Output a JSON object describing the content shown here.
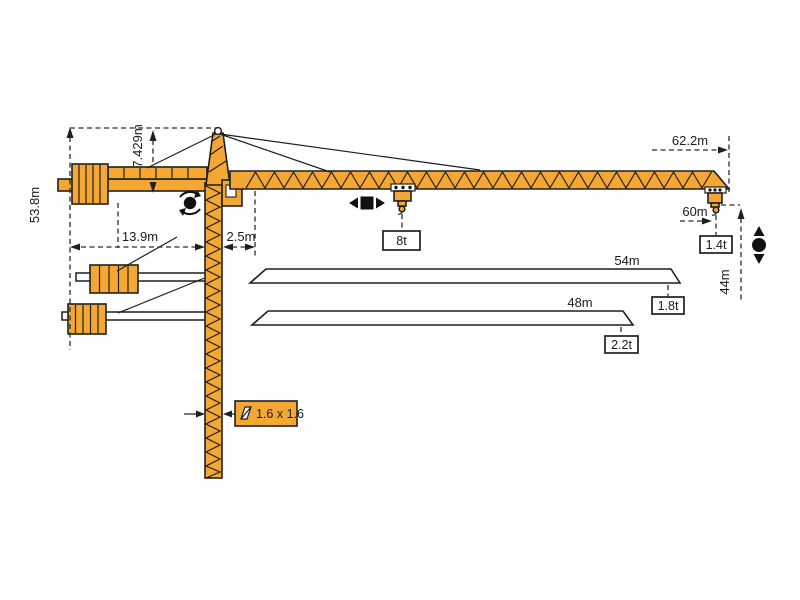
{
  "title": "Tower crane working range and dimension diagram",
  "colors": {
    "crane_orange": "#F5A733",
    "line_black": "#1f1f1f",
    "box_white": "#ffffff"
  },
  "dimensions": {
    "overall_height": "53.8m",
    "tower_head_height": "7.429m",
    "counterjib_radius": "13.9m",
    "jib_foot_offset": "2.5m",
    "max_jib_length": "62.2m",
    "max_hook_radius": "60m",
    "hook_height_at_tip": "44m"
  },
  "loads": {
    "max_load": "8t",
    "tip_load_max_jib": "1.4t",
    "variants": [
      {
        "jib_length": "54m",
        "tip_load": "1.8t"
      },
      {
        "jib_length": "48m",
        "tip_load": "2.2t"
      }
    ]
  },
  "mast": {
    "section_label": "1.6 x 1.6"
  },
  "icons": {
    "slewing": "circle with rotation arrows",
    "trolley_travel": "black square with left/right arrows",
    "hoisting": "black circle with up/down arrows",
    "mast_section": "slashed square section symbol"
  }
}
